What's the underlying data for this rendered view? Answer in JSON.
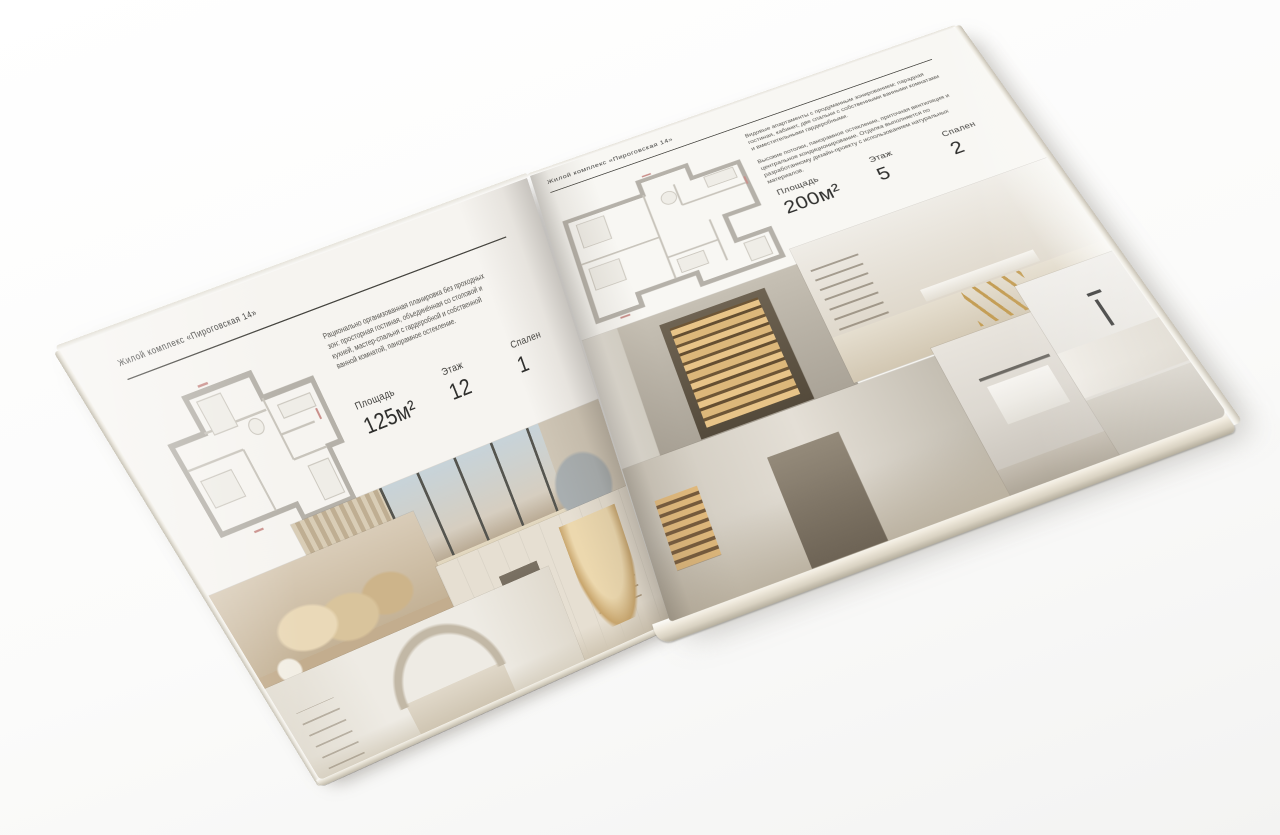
{
  "scene": {
    "surface_color": "#f6f6f5",
    "paper_color": "#f6f4f0",
    "ink_color": "#3b3b39"
  },
  "pages": {
    "left": {
      "header": "Жилой комплекс «Пироговская 14»",
      "description": "Рационально организованная планировка без проходных зон: просторная гостиная, объединённая со столовой и кухней, мастер-спальня с гардеробной и собственной ванной комнатой, панорамное остекление.",
      "stats": [
        {
          "label": "Площадь",
          "value": "125м²"
        },
        {
          "label": "Этаж",
          "value": "12"
        },
        {
          "label": "Спален",
          "value": "1"
        }
      ],
      "floor_plan": "one-bedroom-apartment-plan",
      "photos": [
        {
          "name": "photo-bedroom-panorama",
          "subject": "спальня с панорамным окном и видом на город"
        },
        {
          "name": "photo-bed-pillows",
          "subject": "кровать с подушками и банкеткой изумрудного цвета"
        },
        {
          "name": "photo-arched-shelving",
          "subject": "стеллаж с арочными нишами и подсветкой"
        },
        {
          "name": "photo-light-bedroom",
          "subject": "светлая спальня с декором над изголовьем"
        }
      ]
    },
    "right": {
      "header": "Жилой комплекс «Пироговская 14»",
      "description_1": "Видовые апартаменты с продуманным зонированием: парадная гостиная, кабинет, две спальни с собственными ванными комнатами и вместительными гардеробными.",
      "description_2": "Высокие потолки, панорамное остекление, приточная вентиляция и центральное кондиционирование. Отделка выполняется по разработанному дизайн-проекту с использованием натуральных материалов.",
      "stats": [
        {
          "label": "Площадь",
          "value": "200м²"
        },
        {
          "label": "Этаж",
          "value": "5"
        },
        {
          "label": "Спален",
          "value": "2"
        }
      ],
      "floor_plan": "two-bedroom-apartment-plan",
      "photos": [
        {
          "name": "photo-bar-cabinet",
          "subject": "витрина с подсвеченными барными полками"
        },
        {
          "name": "photo-study-desk",
          "subject": "кабинет со столом на скульптурных золотых опорах"
        },
        {
          "name": "photo-hallway",
          "subject": "холл с подсвеченной нишей"
        },
        {
          "name": "photo-bathroom-towels",
          "subject": "ванная комната с полотенцами"
        },
        {
          "name": "photo-counter-faucet",
          "subject": "столешница с чёрным смесителем"
        }
      ]
    }
  },
  "colors": {
    "shelf_glow": "#e8c488",
    "wood_floor": "#c19a62",
    "bench_teal": "#476660",
    "window_sky": "#c7d3d9"
  }
}
